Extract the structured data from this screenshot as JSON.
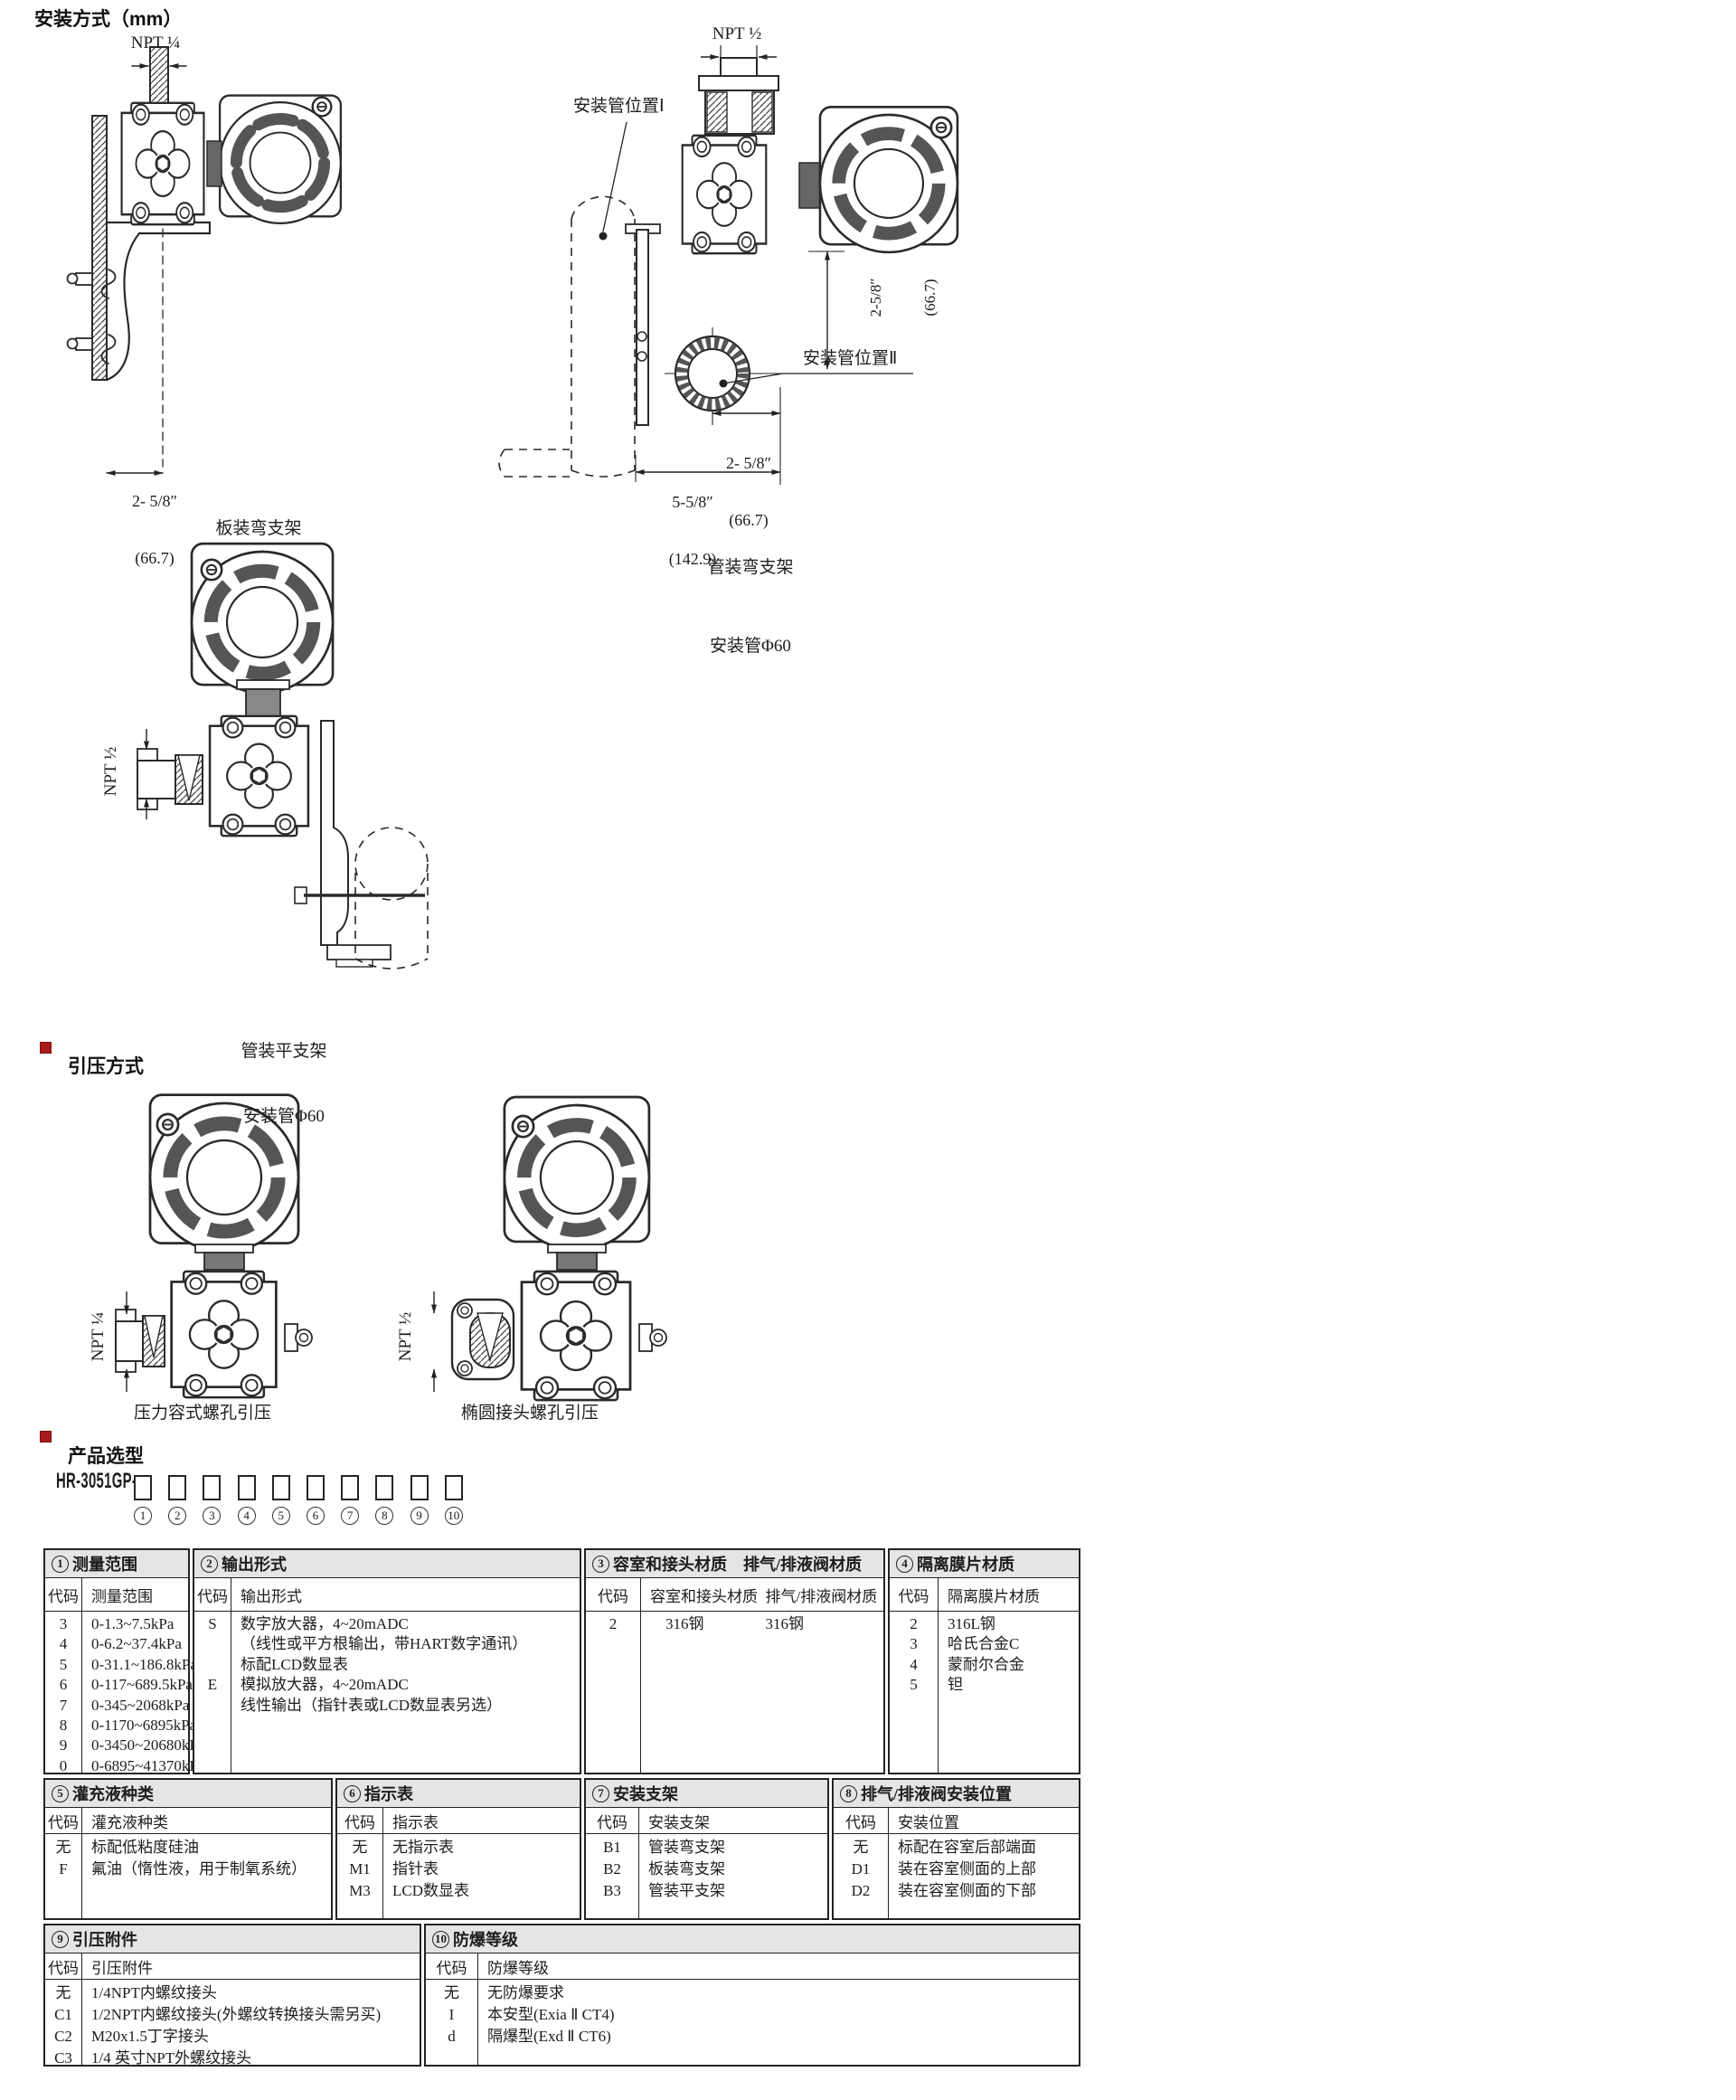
{
  "page": {
    "bg": "#ffffff",
    "accent_red": "#a61c1c"
  },
  "mounting": {
    "heading": "安装方式（mm）",
    "panel_bracket_fig": {
      "npt_label": "NPT ¼",
      "dim_line1": "2- 5/8″",
      "dim_line2": "(66.7)",
      "caption": "板装弯支架"
    },
    "pipe_bent_fig": {
      "npt_label": "NPT ½",
      "pipe_pos1_label": "安装管位置Ⅰ",
      "pipe_pos2_label": "安装管位置Ⅱ",
      "vdim_line1": "2-5/8″",
      "vdim_line2": "(66.7)",
      "hdim1_line1": "2- 5/8″",
      "hdim1_line2": "(66.7)",
      "hdim2_line1": "5-5/8″",
      "hdim2_line2": "(142.9)",
      "caption_line1": "管装弯支架",
      "caption_line2": "安装管Φ60"
    },
    "pipe_flat_fig": {
      "npt_label": "NPT ½",
      "caption_line1": "管装平支架",
      "caption_line2": "安装管Φ60"
    }
  },
  "pressure": {
    "heading": "引压方式",
    "chamber_fig": {
      "npt_label": "NPT ¼",
      "caption": "压力容式螺孔引压"
    },
    "oval_fig": {
      "npt_label": "NPT ½",
      "caption": "椭圆接头螺孔引压"
    }
  },
  "selection": {
    "heading": "产品选型",
    "model_prefix": "HR-3051GP-",
    "positions": [
      "1",
      "2",
      "3",
      "4",
      "5",
      "6",
      "7",
      "8",
      "9",
      "10"
    ]
  },
  "table": {
    "code_header": "代码",
    "bands": [
      [
        {
          "num": "1",
          "title": "测量范围",
          "value_header": "测量范围",
          "rows": [
            [
              "3",
              "0-1.3~7.5kPa"
            ],
            [
              "4",
              "0-6.2~37.4kPa"
            ],
            [
              "5",
              "0-31.1~186.8kPa"
            ],
            [
              "6",
              "0-117~689.5kPa"
            ],
            [
              "7",
              "0-345~2068kPa"
            ],
            [
              "8",
              "0-1170~6895kPa"
            ],
            [
              "9",
              "0-3450~20680kPa"
            ],
            [
              "0",
              "0-6895~41370kPa"
            ]
          ]
        },
        {
          "num": "2",
          "title": "输出形式",
          "value_header": "输出形式",
          "rows": [
            [
              "S",
              "数字放大器，4~20mADC"
            ],
            [
              "",
              "（线性或平方根输出，带HART数字通讯）"
            ],
            [
              "",
              "标配LCD数显表"
            ],
            [
              "E",
              "模拟放大器，4~20mADC"
            ],
            [
              "",
              "线性输出（指针表或LCD数显表另选）"
            ]
          ]
        },
        {
          "num": "3",
          "title": "容室和接头材质　排气/排液阀材质",
          "value_header": "容室和接头材质  排气/排液阀材质",
          "rows": [
            [
              "2",
              "　316钢　　　　316钢"
            ]
          ]
        },
        {
          "num": "4",
          "title": "隔离膜片材质",
          "value_header": "隔离膜片材质",
          "rows": [
            [
              "2",
              "316L钢"
            ],
            [
              "3",
              "哈氏合金C"
            ],
            [
              "4",
              "蒙耐尔合金"
            ],
            [
              "5",
              "钽"
            ]
          ]
        }
      ],
      [
        {
          "num": "5",
          "title": "灌充液种类",
          "value_header": "灌充液种类",
          "rows": [
            [
              "无",
              "标配低粘度硅油"
            ],
            [
              "F",
              "氟油（惰性液，用于制氧系统）"
            ]
          ]
        },
        {
          "num": "6",
          "title": "指示表",
          "value_header": "指示表",
          "rows": [
            [
              "无",
              "无指示表"
            ],
            [
              "M1",
              "指针表"
            ],
            [
              "M3",
              "LCD数显表"
            ]
          ]
        },
        {
          "num": "7",
          "title": "安装支架",
          "value_header": "安装支架",
          "rows": [
            [
              "B1",
              "管装弯支架"
            ],
            [
              "B2",
              "板装弯支架"
            ],
            [
              "B3",
              "管装平支架"
            ]
          ]
        },
        {
          "num": "8",
          "title": "排气/排液阀安装位置",
          "value_header": "安装位置",
          "rows": [
            [
              "无",
              "标配在容室后部端面"
            ],
            [
              "D1",
              "装在容室侧面的上部"
            ],
            [
              "D2",
              "装在容室侧面的下部"
            ]
          ]
        }
      ],
      [
        {
          "num": "9",
          "title": "引压附件",
          "value_header": "引压附件",
          "rows": [
            [
              "无",
              "1/4NPT内螺纹接头"
            ],
            [
              "C1",
              "1/2NPT内螺纹接头(外螺纹转换接头需另买)"
            ],
            [
              "C2",
              "M20x1.5丁字接头"
            ],
            [
              "C3",
              "1/4 英寸NPT外螺纹接头"
            ]
          ]
        },
        {
          "num": "10",
          "title": "防爆等级",
          "value_header": "防爆等级",
          "rows": [
            [
              "无",
              "无防爆要求"
            ],
            [
              "I",
              "本安型(Exia Ⅱ CT4)"
            ],
            [
              "d",
              "隔爆型(Exd Ⅱ CT6)"
            ]
          ]
        }
      ]
    ]
  }
}
